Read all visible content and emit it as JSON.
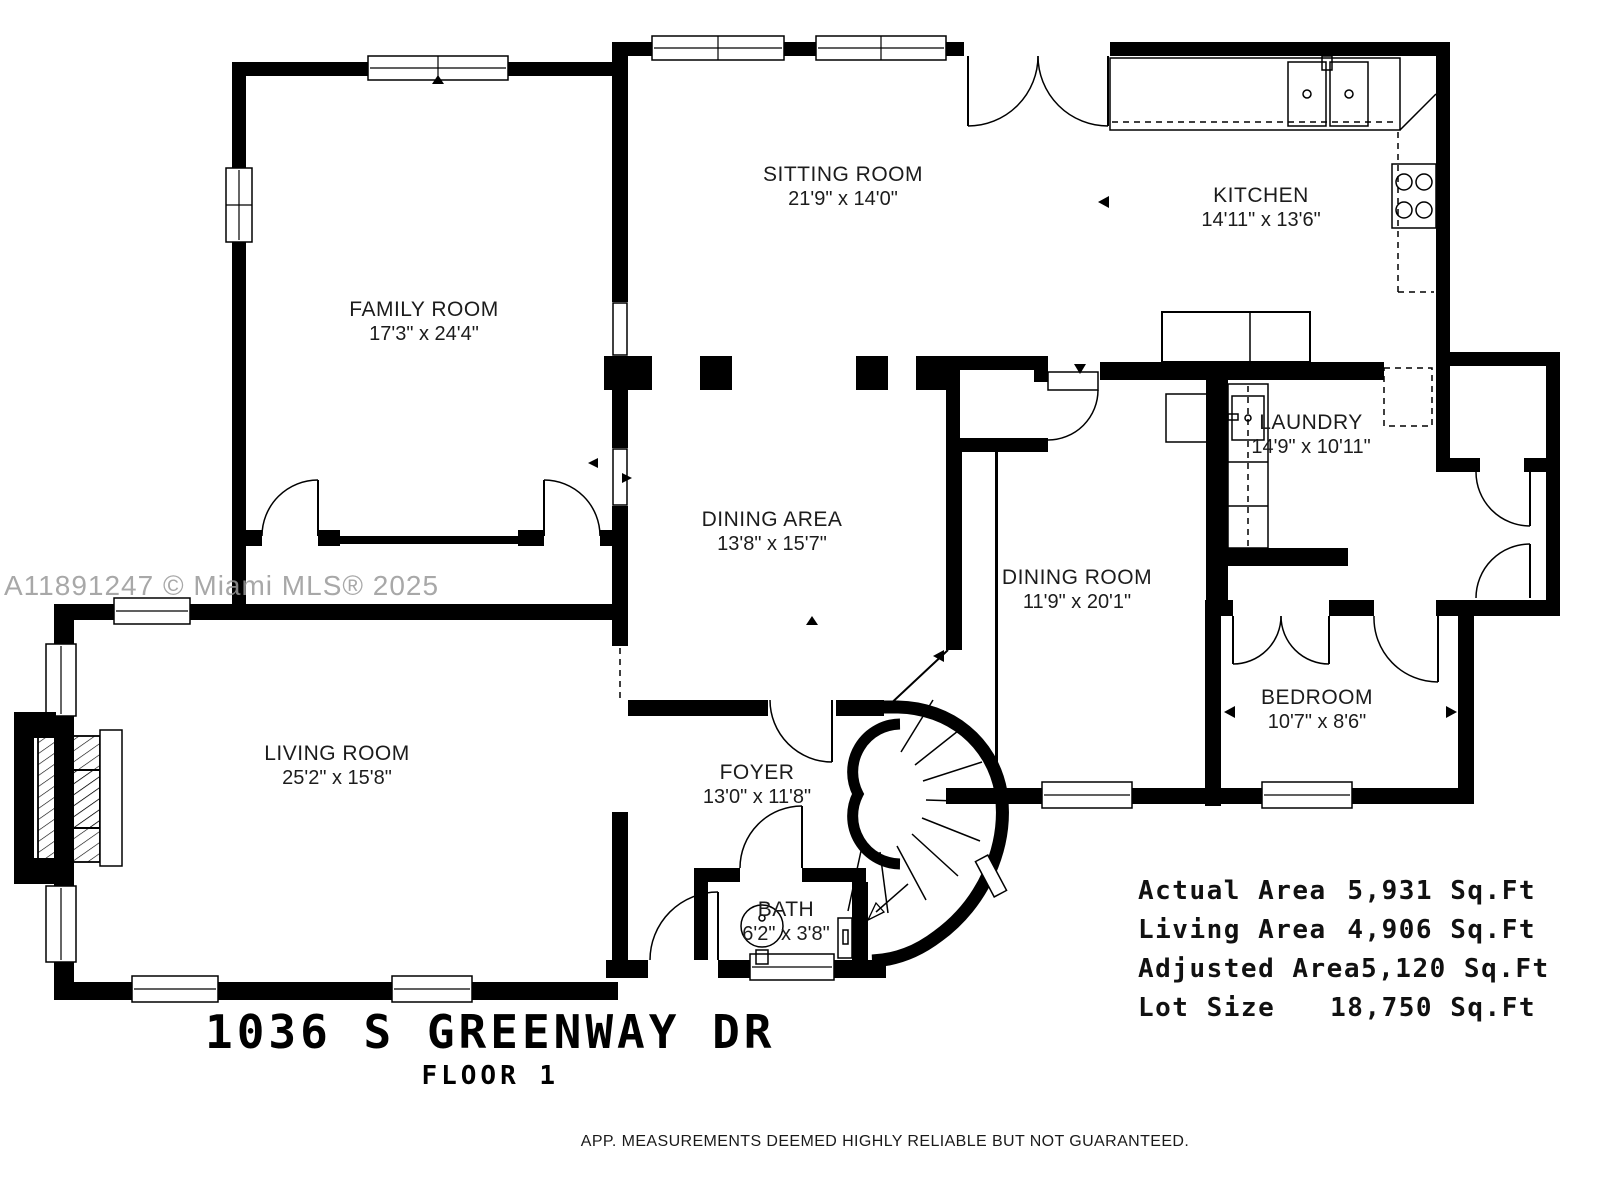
{
  "watermark": "A11891247 © Miami MLS® 2025",
  "title": {
    "address": "1036 S GREENWAY DR",
    "floor": "FLOOR 1"
  },
  "rooms": [
    {
      "name": "FAMILY ROOM",
      "dims": "17'3\" x 24'4\""
    },
    {
      "name": "SITTING ROOM",
      "dims": "21'9\" x 14'0\""
    },
    {
      "name": "KITCHEN",
      "dims": "14'11\" x 13'6\""
    },
    {
      "name": "LAUNDRY",
      "dims": "14'9\" x 10'11\""
    },
    {
      "name": "DINING AREA",
      "dims": "13'8\" x 15'7\""
    },
    {
      "name": "DINING ROOM",
      "dims": "11'9\" x 20'1\""
    },
    {
      "name": "BEDROOM",
      "dims": "10'7\" x 8'6\""
    },
    {
      "name": "LIVING ROOM",
      "dims": "25'2\" x 15'8\""
    },
    {
      "name": "FOYER",
      "dims": "13'0\" x 11'8\""
    },
    {
      "name": "BATH",
      "dims": "6'2\" x 3'8\""
    }
  ],
  "areas": [
    {
      "label": "Actual Area",
      "value": "5,931 Sq.Ft"
    },
    {
      "label": "Living Area",
      "value": "4,906 Sq.Ft"
    },
    {
      "label": "Adjusted Area",
      "value": "5,120 Sq.Ft"
    },
    {
      "label": "Lot Size",
      "value": "18,750 Sq.Ft"
    }
  ],
  "disclaimer": "APP. MEASUREMENTS DEEMED HIGHLY RELIABLE BUT NOT GUARANTEED."
}
